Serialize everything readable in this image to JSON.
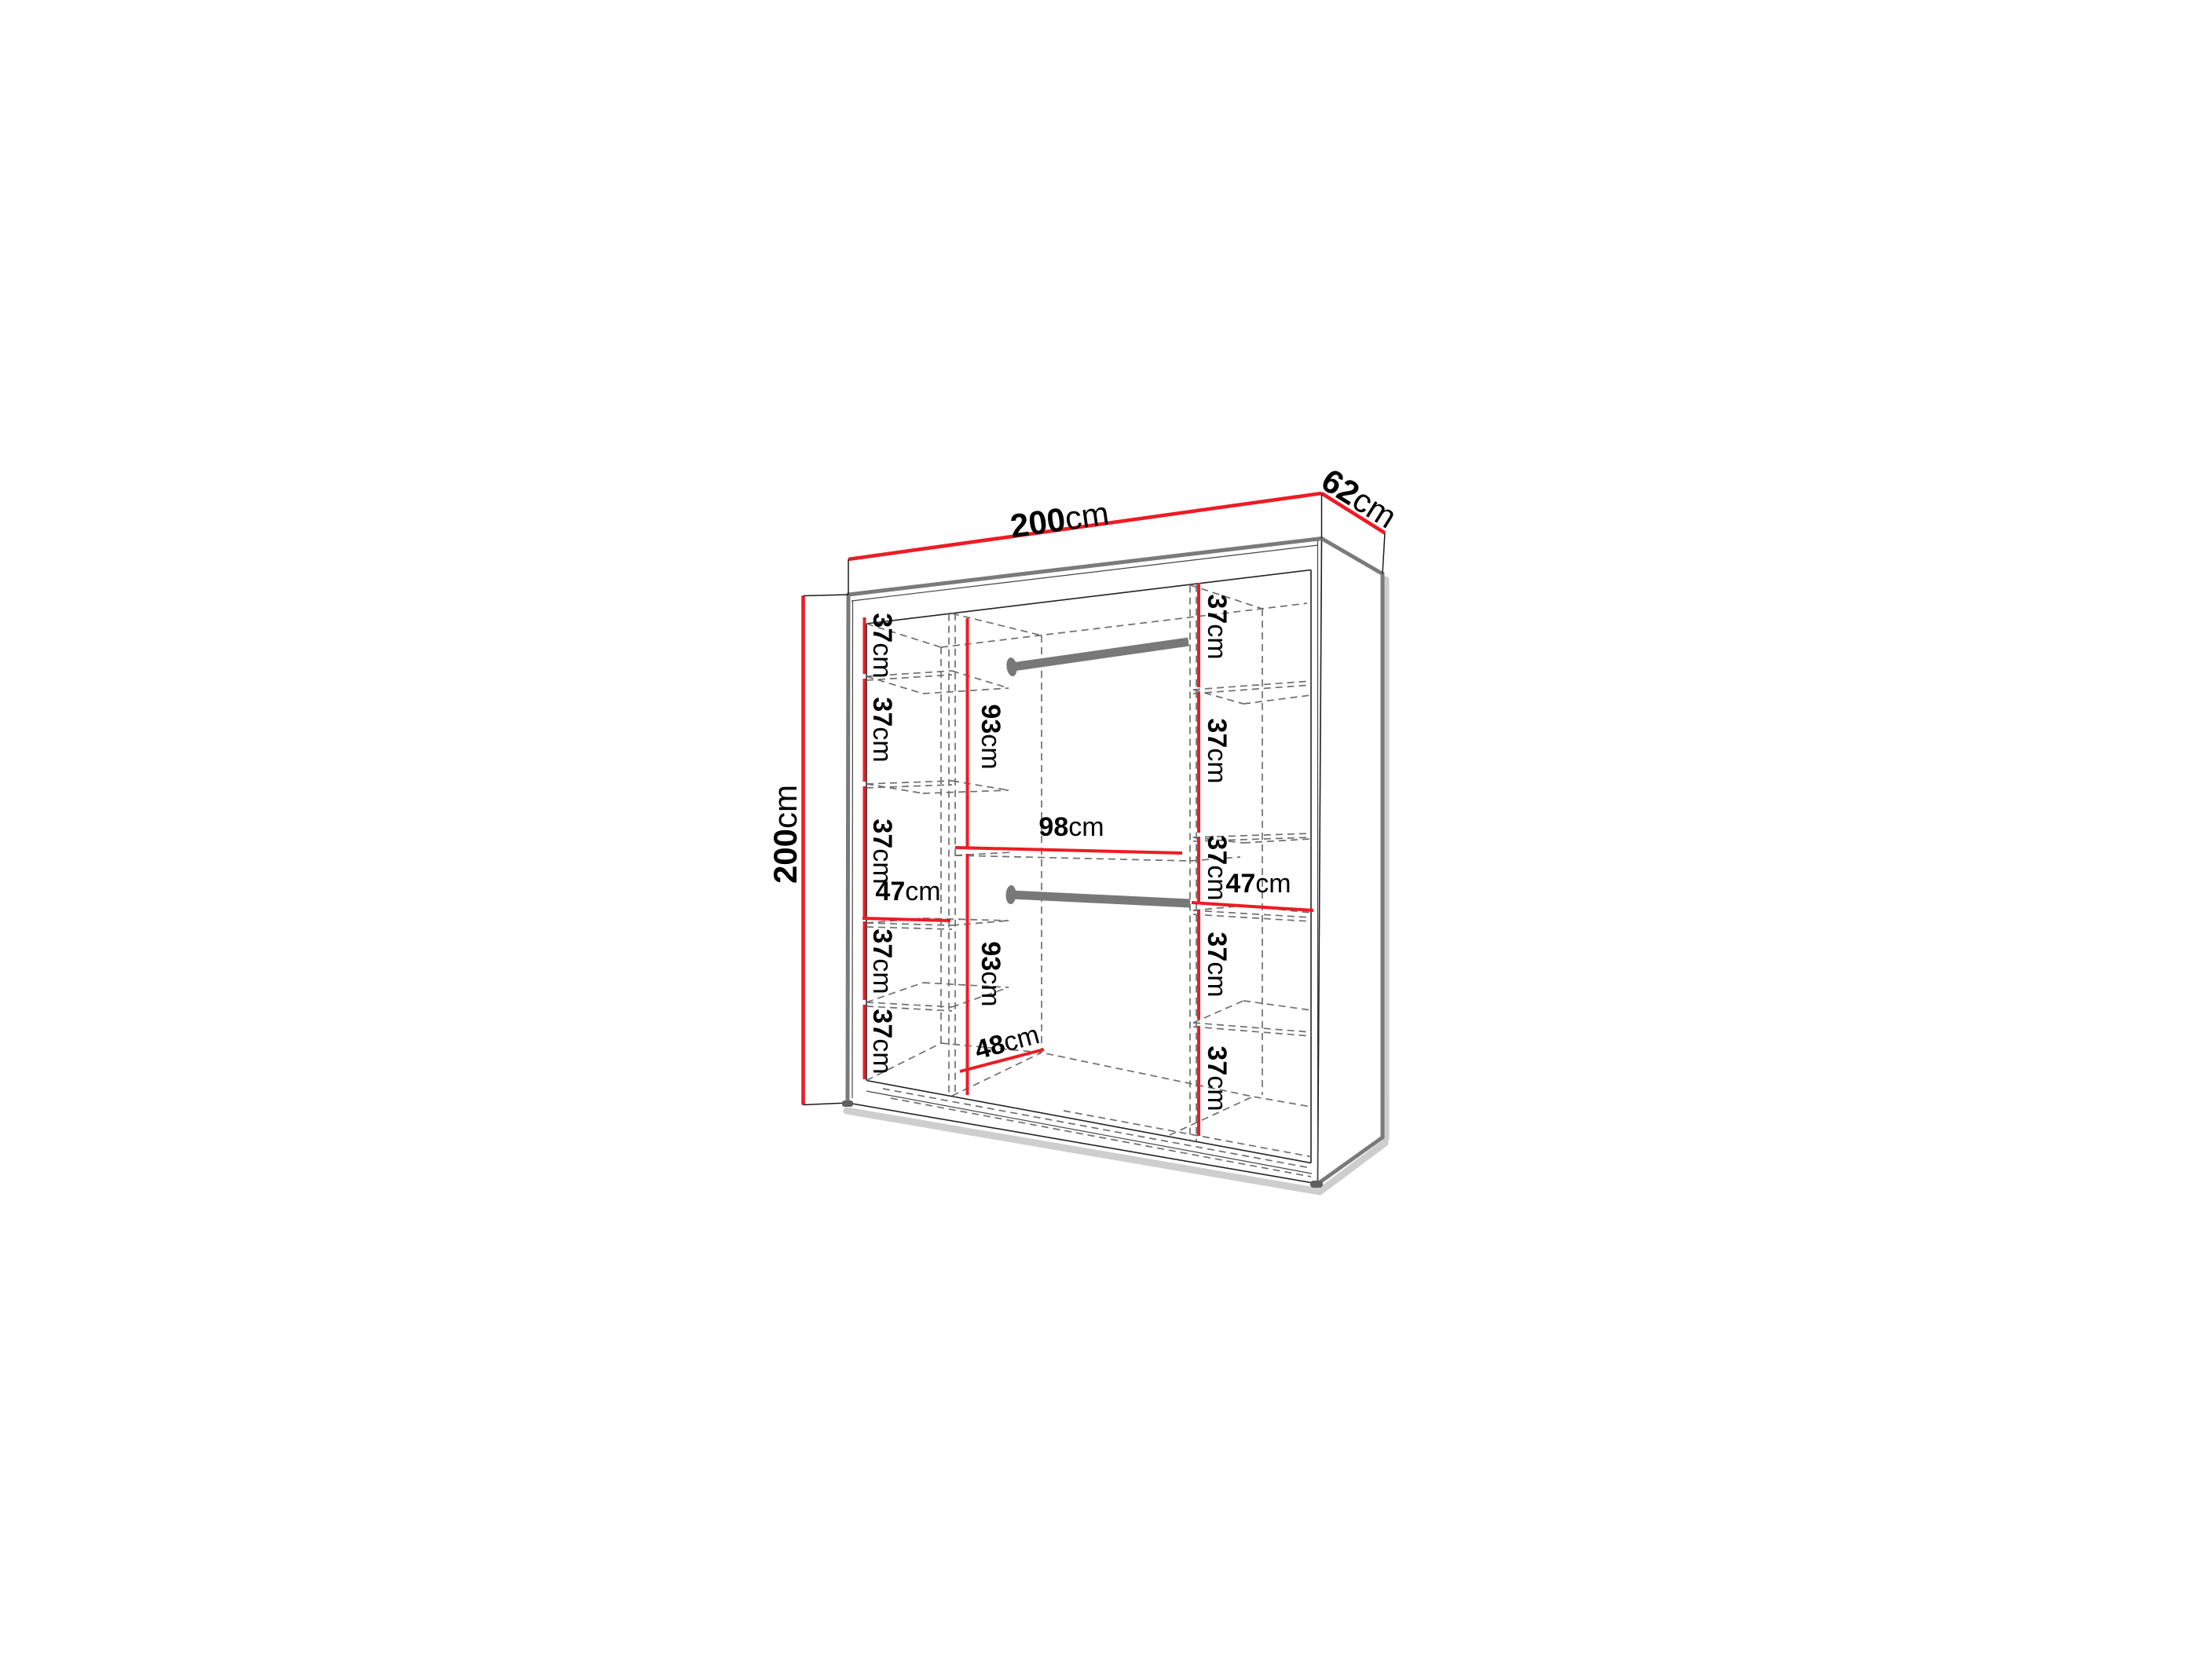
{
  "diagram": {
    "type": "furniture-dimension-diagram",
    "subject": "wardrobe interior layout with dimensions",
    "unit": "cm",
    "accent_color": "#ed1c24",
    "outline_gray": "#7a7a7a",
    "overall": {
      "width_cm": 200,
      "depth_cm": 62,
      "height_cm": 200
    },
    "hanging_rails": 2,
    "labels": {
      "width_top": {
        "num": "200",
        "unit": "cm"
      },
      "depth_top": {
        "num": "62",
        "unit": "cm"
      },
      "height_left": {
        "num": "200",
        "unit": "cm"
      },
      "left": {
        "s1": {
          "num": "37",
          "unit": "cm"
        },
        "s2": {
          "num": "37",
          "unit": "cm"
        },
        "s3": {
          "num": "37",
          "unit": "cm"
        },
        "s4": {
          "num": "37",
          "unit": "cm"
        },
        "s5": {
          "num": "37",
          "unit": "cm"
        },
        "width": {
          "num": "47",
          "unit": "cm"
        }
      },
      "mid": {
        "upper": {
          "num": "93",
          "unit": "cm"
        },
        "width": {
          "num": "98",
          "unit": "cm"
        },
        "lower": {
          "num": "93",
          "unit": "cm"
        },
        "floor_depth": {
          "num": "48",
          "unit": "cm"
        }
      },
      "right": {
        "s1": {
          "num": "37",
          "unit": "cm"
        },
        "s2": {
          "num": "37",
          "unit": "cm"
        },
        "s3": {
          "num": "37",
          "unit": "cm"
        },
        "s4": {
          "num": "37",
          "unit": "cm"
        },
        "s5": {
          "num": "37",
          "unit": "cm"
        },
        "width": {
          "num": "47",
          "unit": "cm"
        }
      }
    }
  }
}
